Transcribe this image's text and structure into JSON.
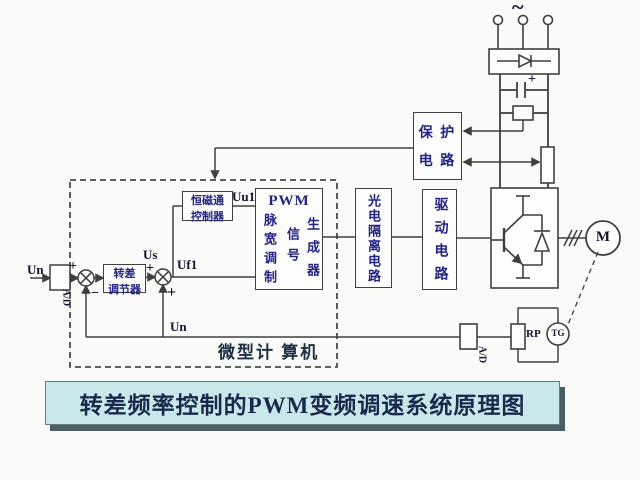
{
  "colors": {
    "background": "#fafaf8",
    "line": "#3f3f3f",
    "block_text_blue": "#232384",
    "label_text": "#14142e",
    "title_bg": "#c9e8ea",
    "title_text": "#1b2a4c",
    "title_shadow": "#4a5e63"
  },
  "title": {
    "text": "转差频率控制的PWM变频调速系统原理图"
  },
  "power": {
    "ac_symbol": "~",
    "cap_plus": "+"
  },
  "blocks": {
    "protection": {
      "line1": "保 护",
      "line2": "电 路"
    },
    "slip_regulator": {
      "line1": "转差",
      "line2": "调节器"
    },
    "flux_controller": {
      "line1": "恒磁通",
      "line2": "控制器"
    },
    "pwm": {
      "title": "PWM",
      "left_col": "脉宽调制",
      "mid_col": "信号",
      "right_col": "生成器"
    },
    "opto_isolation": {
      "text": "光电隔离电路"
    },
    "driver": {
      "text": "驱动电路"
    },
    "microcomputer_label": "微型计 算机",
    "motor": {
      "text": "M"
    },
    "tacho": {
      "text": "TG"
    },
    "rp": {
      "text": "RP"
    },
    "ad_input": {
      "text": "A/D"
    },
    "ad_feedback": {
      "text": "A/D"
    }
  },
  "signals": {
    "un_input": "Un",
    "plus_top": "+",
    "minus": "−",
    "us": "Us",
    "plus_mid": "+",
    "plus_bottom": "+",
    "uf1": "Uf1",
    "uu1": "Uu1",
    "un_feedback": "Un",
    "three_phase_marks": "///"
  }
}
